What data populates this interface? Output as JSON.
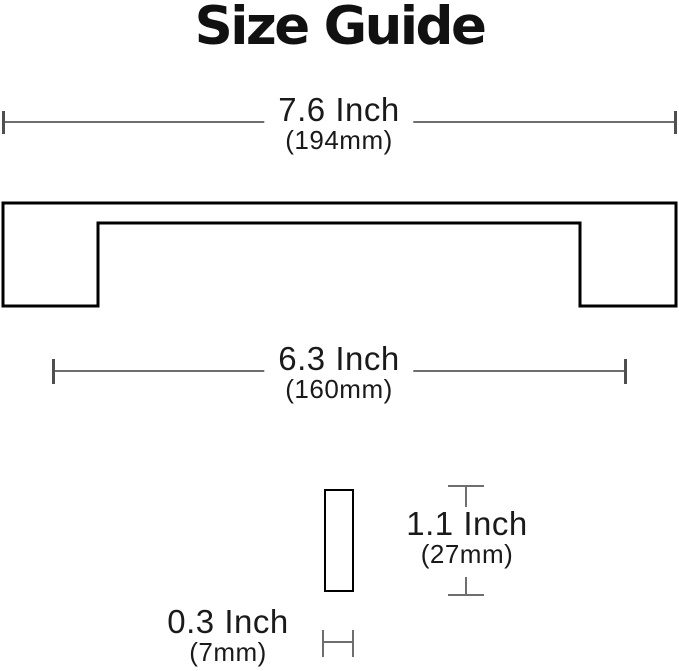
{
  "title": "Size Guide",
  "dimensions": {
    "overall_length": {
      "inch": "7.6 Inch",
      "mm": "(194mm)"
    },
    "hole_spacing": {
      "inch": "6.3 Inch",
      "mm": "(160mm)"
    },
    "height": {
      "inch": "1.1 Inch",
      "mm": "(27mm)"
    },
    "thickness": {
      "inch": "0.3 Inch",
      "mm": "(7mm)"
    }
  },
  "colors": {
    "title": "#111111",
    "text": "#1a1a1a",
    "line": "#6e6e6e",
    "tick": "#4f4f4f",
    "outline": "#000000",
    "background": "#ffffff"
  }
}
